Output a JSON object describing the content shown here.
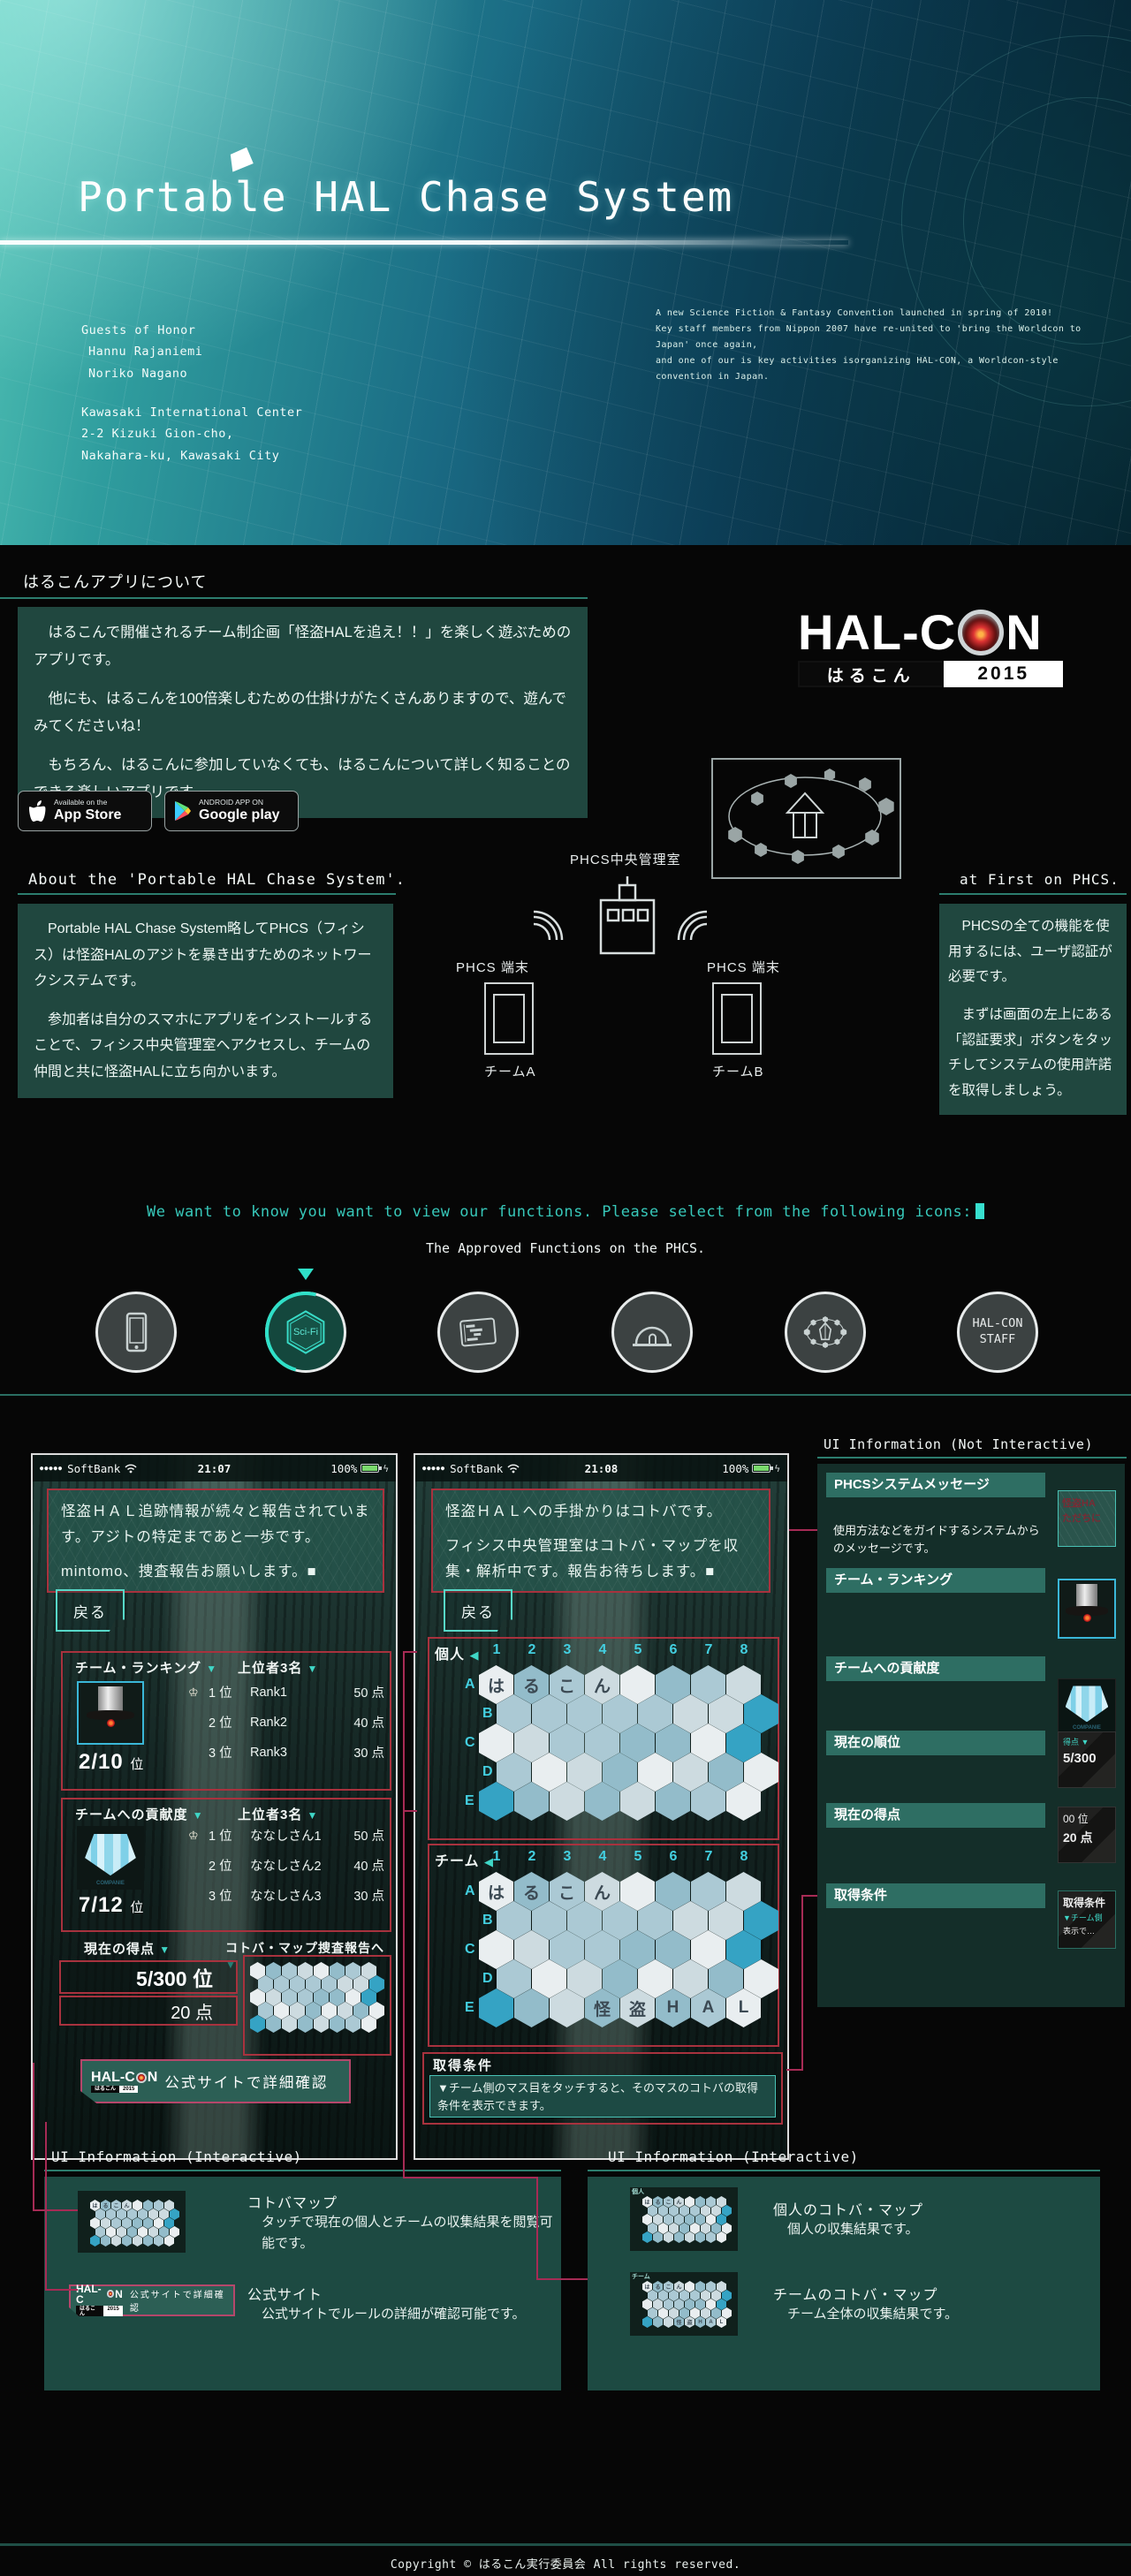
{
  "hero": {
    "title": "Portable HAL Chase System",
    "guests": [
      "Guests of Honor",
      "Hannu Rajaniemi",
      "Noriko Nagano"
    ],
    "venue": [
      "Kawasaki International Center",
      "2-2 Kizuki Gion-cho,",
      "Nakahara-ku, Kawasaki City"
    ],
    "intro": [
      "A new Science Fiction & Fantasy Convention launched in spring of 2010!",
      "Key staff members from Nippon 2007 have re-united to 'bring the Worldcon to Japan' once again,",
      "and one of our is key activities isorganizing HAL-CON, a Worldcon-style convention in Japan."
    ]
  },
  "about_app": {
    "heading": "はるこんアプリについて",
    "paragraphs": [
      "　はるこんで開催されるチーム制企画「怪盗HALを追え！！」を楽しく遊ぶためのアプリです。",
      "　他にも、はるこんを100倍楽しむための仕掛けがたくさんありますので、遊んでみてくださいね！",
      "　もちろん、はるこんに参加していなくても、はるこんについて詳しく知ることのできる楽しいアプリです。"
    ]
  },
  "badges": {
    "appstore_top": "Available on the",
    "appstore_bottom": "App Store",
    "gplay_top": "ANDROID APP ON",
    "gplay_bottom": "Google play"
  },
  "logo": {
    "left": "HAL-C",
    "right": "N",
    "sub_left": "はるこん",
    "sub_right": "2015"
  },
  "about_phcs": {
    "heading": "About the 'Portable HAL Chase System'.",
    "paragraphs": [
      "　Portable HAL Chase System略してPHCS（フィシス）は怪盗HALのアジトを暴き出すためのネットワークシステムです。",
      "　参加者は自分のスマホにアプリをインストールすることで、フィシス中央管理室へアクセスし、チームの仲間と共に怪盗HALに立ち向かいます。"
    ]
  },
  "first_phcs": {
    "heading": "at First on PHCS.",
    "paragraphs": [
      "　PHCSの全ての機能を使用するには、ユーザ認証が必要です。",
      "　まずは画面の左上にある「認証要求」ボタンをタッチしてシステムの使用許諾を取得しましょう。"
    ]
  },
  "diagram": {
    "center_label": "PHCS中央管理室",
    "terminal_label": "PHCS 端末",
    "team_a": "チームA",
    "team_b": "チームB"
  },
  "functions": {
    "prompt": "We want to know you want to view our functions. Please select from the following icons:",
    "subtitle": "The Approved Functions on the PHCS.",
    "icons": [
      {
        "name": "smartphone",
        "label": ""
      },
      {
        "name": "sci-fi-hexagon",
        "label": "Sci-Fi"
      },
      {
        "name": "schedule-card",
        "label": ""
      },
      {
        "name": "dome",
        "label": ""
      },
      {
        "name": "hex-network",
        "label": ""
      },
      {
        "name": "hal-con-staff",
        "line1": "HAL-CON",
        "line2": "STAFF"
      }
    ]
  },
  "ui_static": {
    "heading": "UI Information (Not Interactive)",
    "items": [
      {
        "label": "PHCSシステムメッセージ",
        "desc": "使用方法などをガイドするシステムからのメッセージです。",
        "thumb": [
          "怪盗HA",
          "ただちに"
        ]
      },
      {
        "label": "チーム・ランキング"
      },
      {
        "label": "チームへの貢献度"
      },
      {
        "label": "現在の順位",
        "thumb": [
          "得点 ▼",
          "5/300"
        ]
      },
      {
        "label": "現在の得点",
        "thumb": [
          "00 位",
          "20 点"
        ]
      },
      {
        "label": "取得条件",
        "thumb": [
          "取得条件",
          "▼チーム側",
          "表示で…"
        ]
      }
    ]
  },
  "phone_left": {
    "status": {
      "dots": "●●●●●",
      "carrier": "SoftBank",
      "time": "21:07",
      "battery": "100%"
    },
    "message": [
      "怪盗ＨＡＬ追跡情報が続々と報告されています。アジトの特定まであと一歩です。",
      "mintomo、捜査報告お願いします。■"
    ],
    "back": "戻る",
    "ranking": {
      "title": "チーム・ランキング",
      "top3": "上位者3名",
      "rank": "2/10",
      "rank_unit": "位",
      "rows": [
        [
          "1 位",
          "Rank1",
          "50 点"
        ],
        [
          "2 位",
          "Rank2",
          "40 点"
        ],
        [
          "3 位",
          "Rank3",
          "30 点"
        ]
      ]
    },
    "contribution": {
      "title": "チームへの貢献度",
      "top3": "上位者3名",
      "rank": "7/12",
      "rank_unit": "位",
      "rows": [
        [
          "1 位",
          "ななしさん1",
          "50 点"
        ],
        [
          "2 位",
          "ななしさん2",
          "40 点"
        ],
        [
          "3 位",
          "ななしさん3",
          "30 点"
        ]
      ]
    },
    "score_label": "現在の得点",
    "map_link": "コトバ・マップ捜査報告へ",
    "rank_value": "5/300 位",
    "score_value": "20 点",
    "banner_text": "公式サイトで詳細確認"
  },
  "phone_right": {
    "status": {
      "dots": "●●●●●",
      "carrier": "SoftBank",
      "time": "21:08",
      "battery": "100%"
    },
    "message": [
      "怪盗ＨＡＬへの手掛かりはコトバです。",
      "フィシス中央管理室はコトバ・マップを収集・解析中です。報告お待ちします。■"
    ],
    "back": "戻る",
    "personal_label": "個人",
    "team_label": "チーム",
    "cols": [
      "1",
      "2",
      "3",
      "4",
      "5",
      "6",
      "7",
      "8"
    ],
    "rows": [
      "A",
      "B",
      "C",
      "D",
      "E"
    ],
    "conditions": {
      "title": "取得条件",
      "body": "▼チーム側のマス目をタッチすると、そのマスのコトバの取得条件を表示できます。"
    }
  },
  "interactive_left": {
    "heading": "UI Information (Interactive)",
    "items": [
      {
        "title": "コトバマップ",
        "desc": "タッチで現在の個人とチームの収集結果を閲覧可能です。"
      },
      {
        "title": "公式サイト",
        "desc": "公式サイトでルールの詳細が確認可能です。"
      }
    ]
  },
  "interactive_right": {
    "heading": "UI Information (Interactive)",
    "items": [
      {
        "title": "個人のコトバ・マップ",
        "desc": "個人の収集結果です。"
      },
      {
        "title": "チームのコトバ・マップ",
        "desc": "チーム全体の収集結果です。"
      }
    ]
  },
  "footer": {
    "text": "Copyright © はるこん実行委員会 All rights reserved."
  },
  "hexmaps": {
    "personal": {
      "0,0": "は",
      "0,1": "る",
      "0,2": "こ",
      "0,3": "ん"
    },
    "team": {
      "0,0": "は",
      "0,1": "る",
      "0,2": "こ",
      "0,3": "ん",
      "4,3": "怪",
      "4,4": "盗",
      "4,5": "H",
      "4,6": "A",
      "4,7": "L"
    },
    "accents": [
      [
        1,
        7
      ],
      [
        2,
        7
      ],
      [
        4,
        0
      ]
    ]
  },
  "colors": {
    "accent": "#37c7b9",
    "panel": "#1d4a42",
    "label_bar": "#2e6e63",
    "red_border": "#a8323e",
    "pink_line": "#a62b55",
    "hex_palette": [
      "#e9eef0",
      "#cddbe0",
      "#abc9d4",
      "#93bcca"
    ],
    "hex_accent": "#35a3c4"
  }
}
